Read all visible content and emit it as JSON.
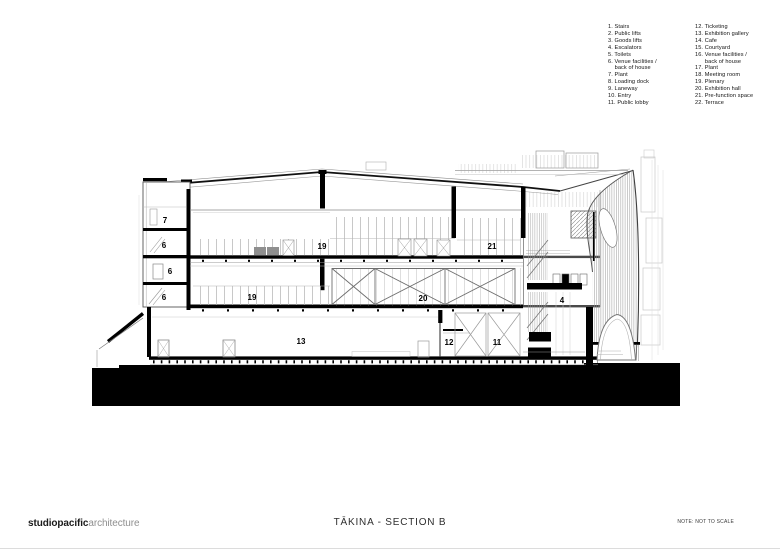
{
  "legend": {
    "col1_lines": [
      "1. Stairs",
      "2. Public lifts",
      "3. Goods lifts",
      "4. Escalators",
      "5. Toilets",
      "6. Venue facilities /",
      "    back of house",
      "7. Plant",
      "8. Loading dock",
      "9. Laneway",
      "10. Entry",
      "11. Public lobby"
    ],
    "col2_lines": [
      "12. Ticketing",
      "13. Exhibition gallery",
      "14. Cafe",
      "15. Courtyard",
      "16. Venue facilities /",
      "      back of house",
      "17. Plant",
      "18. Meeting room",
      "19. Plenary",
      "20. Exhibition hall",
      "21. Pre-function space",
      "22. Terrace"
    ]
  },
  "drawing": {
    "room_labels": [
      {
        "label": "7",
        "x": 165,
        "y": 221
      },
      {
        "label": "6",
        "x": 164,
        "y": 246
      },
      {
        "label": "6",
        "x": 170,
        "y": 272
      },
      {
        "label": "6",
        "x": 164,
        "y": 298
      },
      {
        "label": "19",
        "x": 322,
        "y": 247
      },
      {
        "label": "21",
        "x": 492,
        "y": 247
      },
      {
        "label": "19",
        "x": 252,
        "y": 298
      },
      {
        "label": "20",
        "x": 423,
        "y": 299
      },
      {
        "label": "4",
        "x": 562,
        "y": 301
      },
      {
        "label": "13",
        "x": 301,
        "y": 342
      },
      {
        "label": "12",
        "x": 449,
        "y": 343
      },
      {
        "label": "11",
        "x": 497,
        "y": 343
      }
    ]
  },
  "footer": {
    "logo_bold": "studiopacific",
    "logo_light": "architecture",
    "title": "TĀKINA - SECTION B",
    "note": "NOTE: NOT TO SCALE"
  },
  "colors": {
    "ink": "#000000",
    "line_dark": "#2b2b2b",
    "line_mid": "#8a8a8a",
    "line_light": "#b9b9b9",
    "logo_gray": "#8f8f8f"
  }
}
